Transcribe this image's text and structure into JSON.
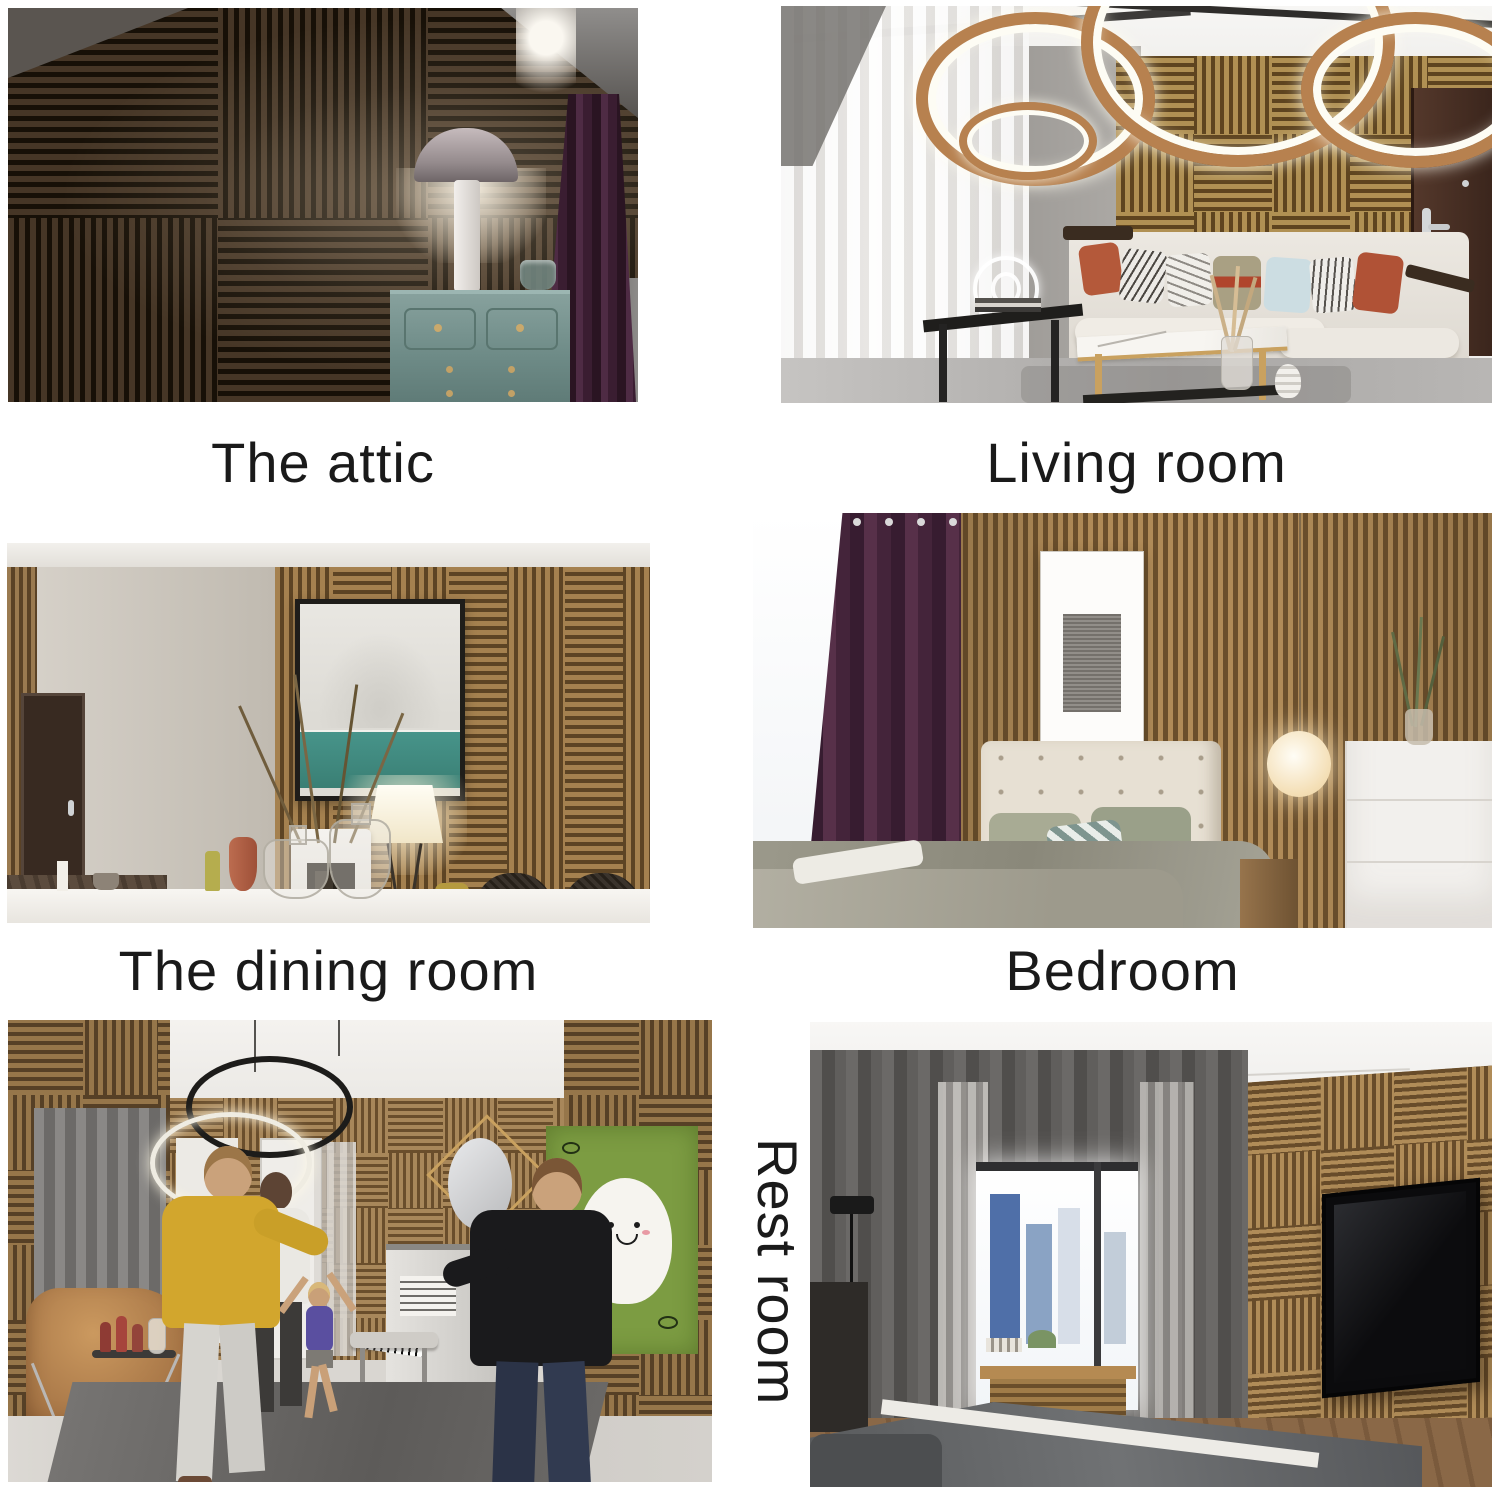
{
  "page": {
    "background_color": "#ffffff",
    "caption_color": "#1a1a1a"
  },
  "captions": {
    "attic": "The attic",
    "living_room": "Living room",
    "dining_room": "The dining room",
    "bedroom": "Bedroom",
    "rest_room": "Rest room"
  },
  "palette": {
    "wood_light": "#b08c58",
    "wood_dark": "#684c2a",
    "attic_wood": "#463626",
    "attic_gap": "#171007",
    "plum_curtain": "#44243a",
    "teal_dresser": "#7a9794",
    "copper_ring": "#b7814f",
    "art_green": "#7c9c42",
    "grey_curtain": "#656361"
  }
}
